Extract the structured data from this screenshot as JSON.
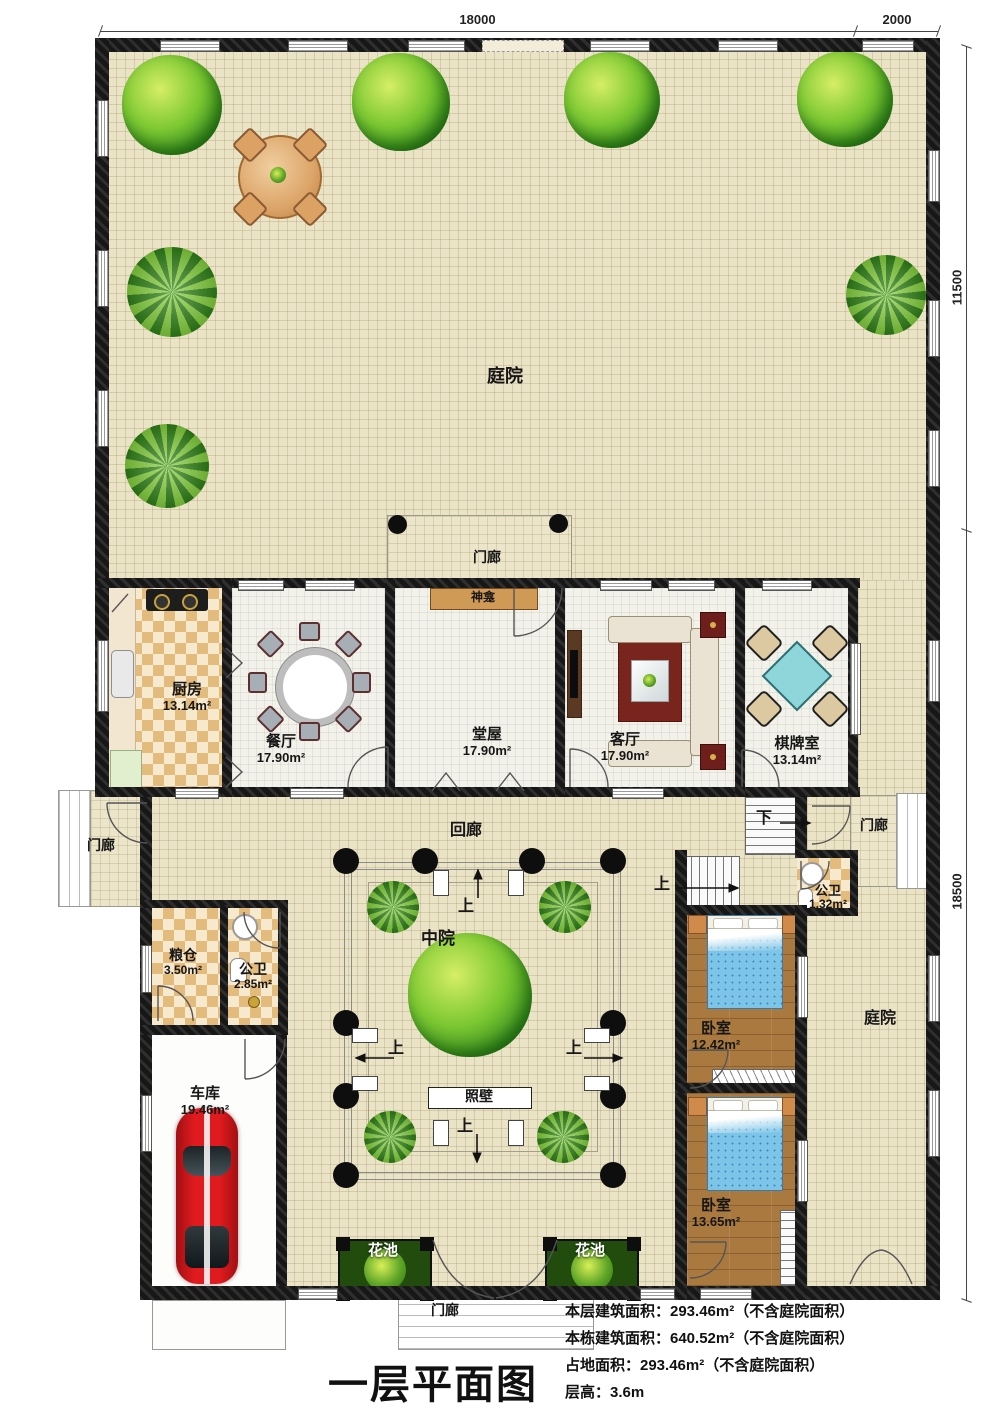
{
  "plan": {
    "title": "一层平面图",
    "scale": "1:100",
    "notes": [
      "本层建筑面积：293.46m²（不含庭院面积）",
      "本栋建筑面积：640.52m²（不含庭院面积）",
      "占地面积：293.46m²（不含庭院面积）",
      "层高：3.6m"
    ]
  },
  "dimensions": {
    "top_width": "18000",
    "top_right": "2000",
    "right_upper": "11500",
    "right_lower": "18500"
  },
  "rooms": {
    "kitchen": {
      "name": "厨房",
      "area": "13.14m²"
    },
    "dining": {
      "name": "餐厅",
      "area": "17.90m²"
    },
    "hall": {
      "name": "堂屋",
      "area": "17.90m²"
    },
    "living": {
      "name": "客厅",
      "area": "17.90m²"
    },
    "chess": {
      "name": "棋牌室",
      "area": "13.14m²"
    },
    "grain": {
      "name": "粮仓",
      "area": "3.50m²"
    },
    "bath_small": {
      "name": "公卫",
      "area": "2.85m²"
    },
    "garage": {
      "name": "车库",
      "area": "19.46m²"
    },
    "bath_right": {
      "name": "公卫",
      "area": "1.32m²"
    },
    "bedroom1": {
      "name": "卧室",
      "area": "12.42m²"
    },
    "bedroom2": {
      "name": "卧室",
      "area": "13.65m²"
    }
  },
  "zones": {
    "courtyard_top": "庭院",
    "courtyard_right": "庭院",
    "corridor": "回廊",
    "middle_court": "中院",
    "screen_wall": "照壁",
    "shrine": "神龛",
    "porch_top": "门廊",
    "porch_left": "门廊",
    "porch_right": "门廊",
    "porch_bottom": "门廊",
    "flower_bed_left": "花池",
    "flower_bed_right": "花池"
  },
  "glyphs": {
    "up": "上",
    "down": "下"
  },
  "colors": {
    "wall": "#171717",
    "courtyard": "#ebe3c6",
    "wood": "#a9793f",
    "bed_blue": "#7cc4e8",
    "car_red": "#cf1418"
  }
}
